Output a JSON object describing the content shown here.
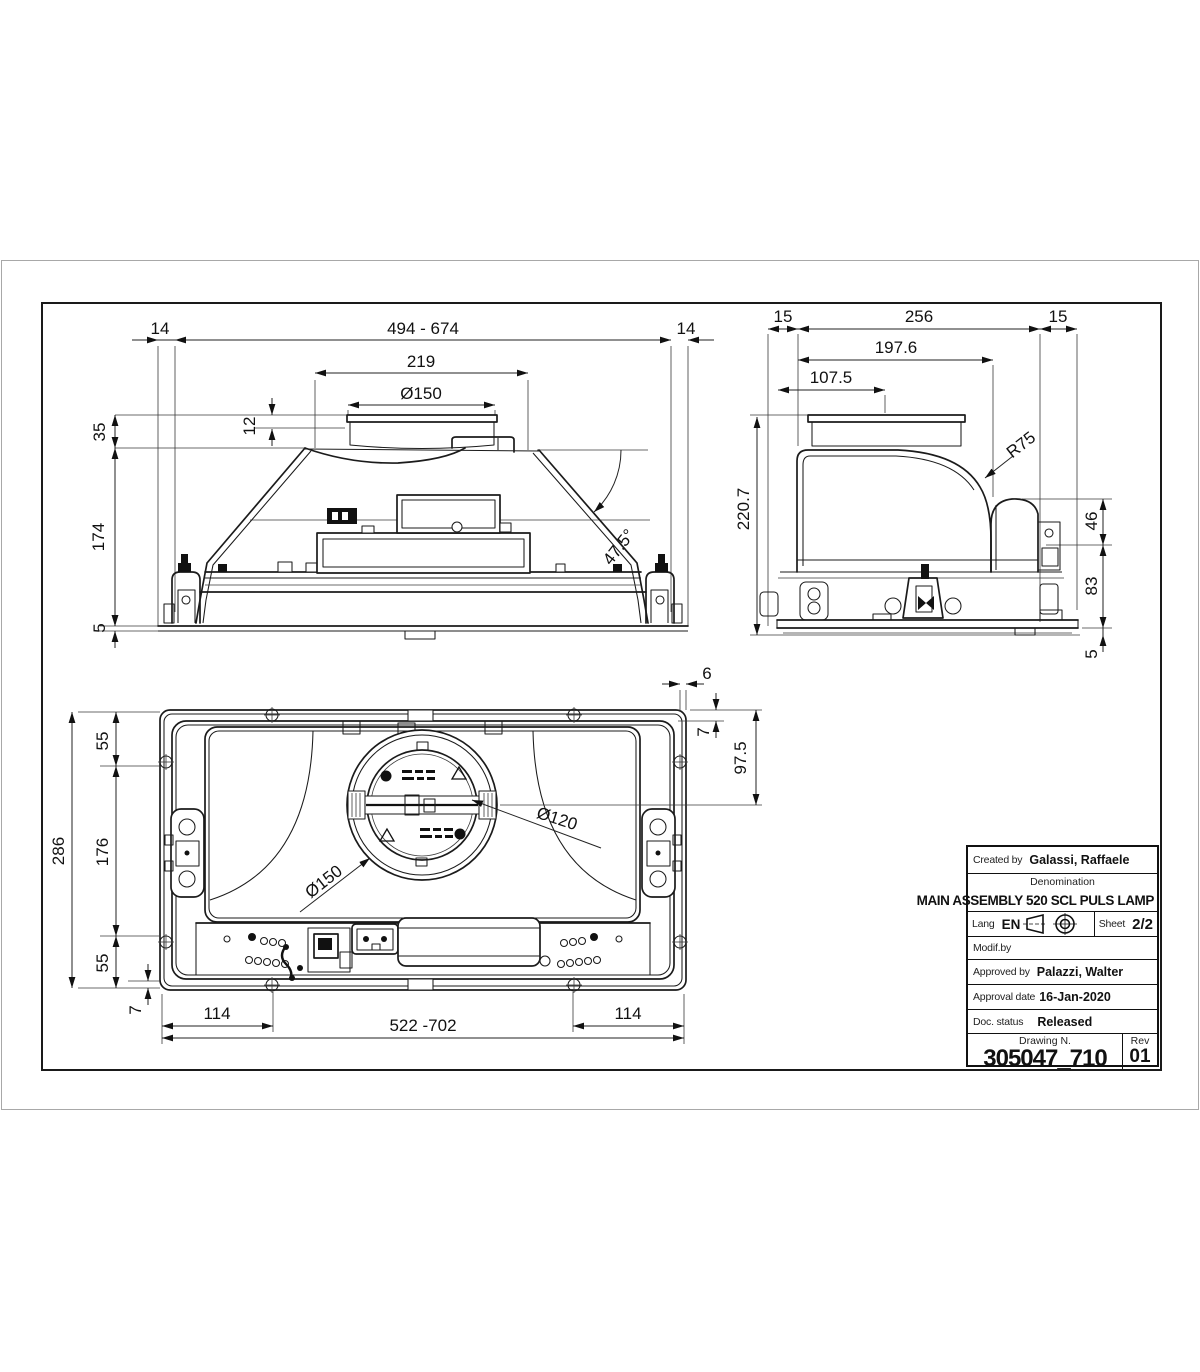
{
  "views": {
    "front": {
      "dims": {
        "overhang_left": "14",
        "width_range": "494 - 674",
        "overhang_right": "14",
        "duct_span": "219",
        "duct_diameter": "Ø150",
        "lip_height": "12",
        "collar_height": "35",
        "body_height": "174",
        "flange_thickness": "5",
        "slope_angle": "47.5°"
      }
    },
    "side": {
      "dims": {
        "offset_back": "15",
        "depth": "256",
        "offset_front": "15",
        "upper_depth": "197.6",
        "duct_center": "107.5",
        "corner_radius": "R75",
        "total_height": "220.7",
        "motor_height": "46",
        "base_height": "83",
        "plate_thickness": "5"
      }
    },
    "bottom": {
      "dims": {
        "rim_offset": "6",
        "liner_offset": "7",
        "fan_center_offset": "97.5",
        "top_margin": "55",
        "hinge_span": "176",
        "bottom_margin": "55",
        "total_height": "286",
        "screw_offset": "7",
        "screw_left": "114",
        "width_range": "522 -702",
        "screw_right": "114",
        "fan_diameter": "Ø150",
        "inner_diameter": "Ø120"
      }
    }
  },
  "title_block": {
    "created_by_label": "Created by",
    "created_by": "Galassi, Raffaele",
    "denomination_label": "Denomination",
    "denomination": "MAIN ASSEMBLY 520 SCL PULS LAMP",
    "lang_label": "Lang",
    "lang_value": "EN",
    "sheet_label": "Sheet",
    "sheet_value": "2/2",
    "modif_by_label": "Modif.by",
    "approved_by_label": "Approved by",
    "approved_by": "Palazzi, Walter",
    "approval_date_label": "Approval date",
    "approval_date": "16-Jan-2020",
    "doc_status_label": "Doc. status",
    "doc_status": "Released",
    "drawing_n_label": "Drawing N.",
    "drawing_number": "305047_710",
    "rev_label": "Rev",
    "rev_value": "01"
  }
}
